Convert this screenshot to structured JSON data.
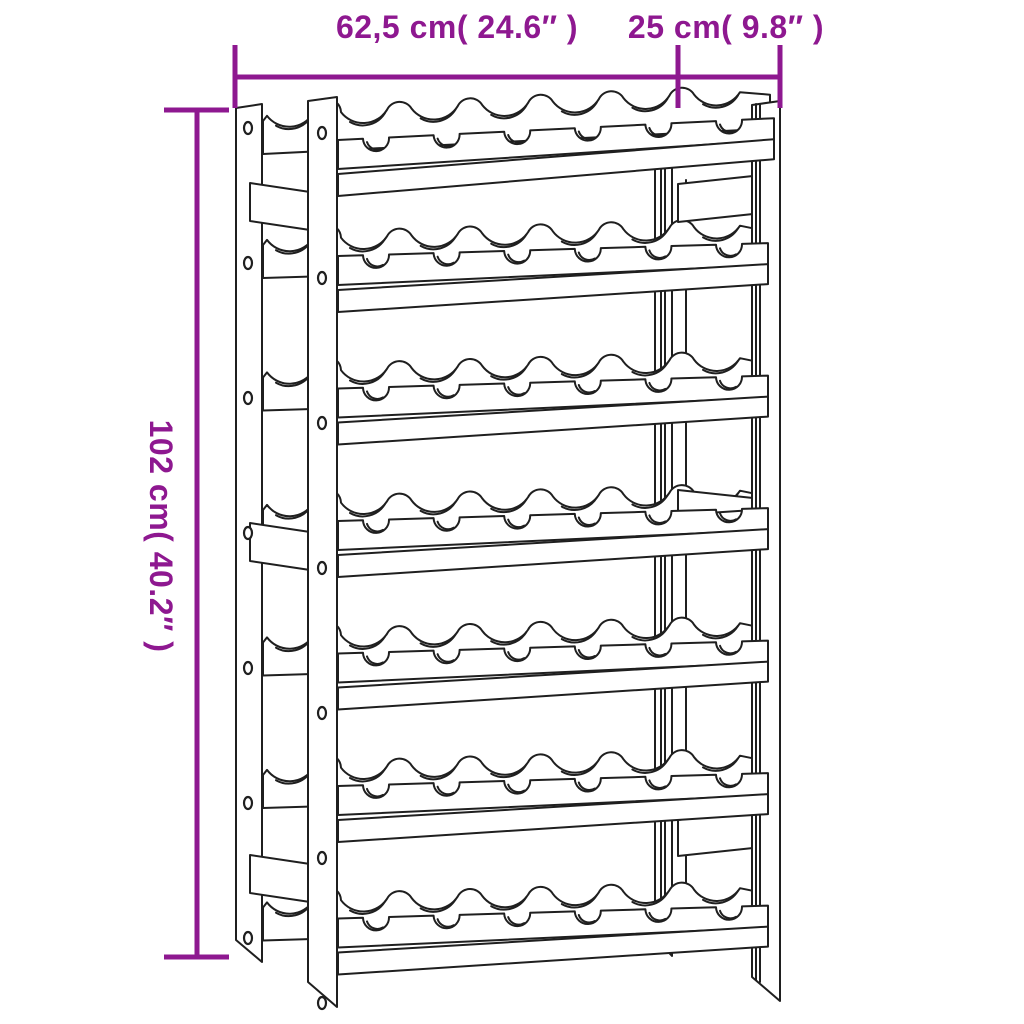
{
  "page": {
    "background_color": "#ffffff"
  },
  "diagram": {
    "kind": "product dimension line drawing",
    "product_name": "wine rack",
    "line_color": "#1f1f1f",
    "fill_color": "#ffffff",
    "dimension_color": "#8e1890",
    "dimensions": {
      "width": {
        "label": "62,5 cm( 24.6″ )",
        "cm": "62,5",
        "inches": "24.6"
      },
      "depth": {
        "label": "25 cm( 9.8″ )",
        "cm": "25",
        "inches": "9.8"
      },
      "height": {
        "label": "102 cm( 40.2″ )",
        "cm": "102",
        "inches": "40.2"
      }
    },
    "structure": {
      "shelf_rows": 7,
      "bottle_slots_per_row": 6,
      "posts": 4,
      "side_brackets_per_side": 3,
      "screws_per_left_post": 7
    }
  }
}
